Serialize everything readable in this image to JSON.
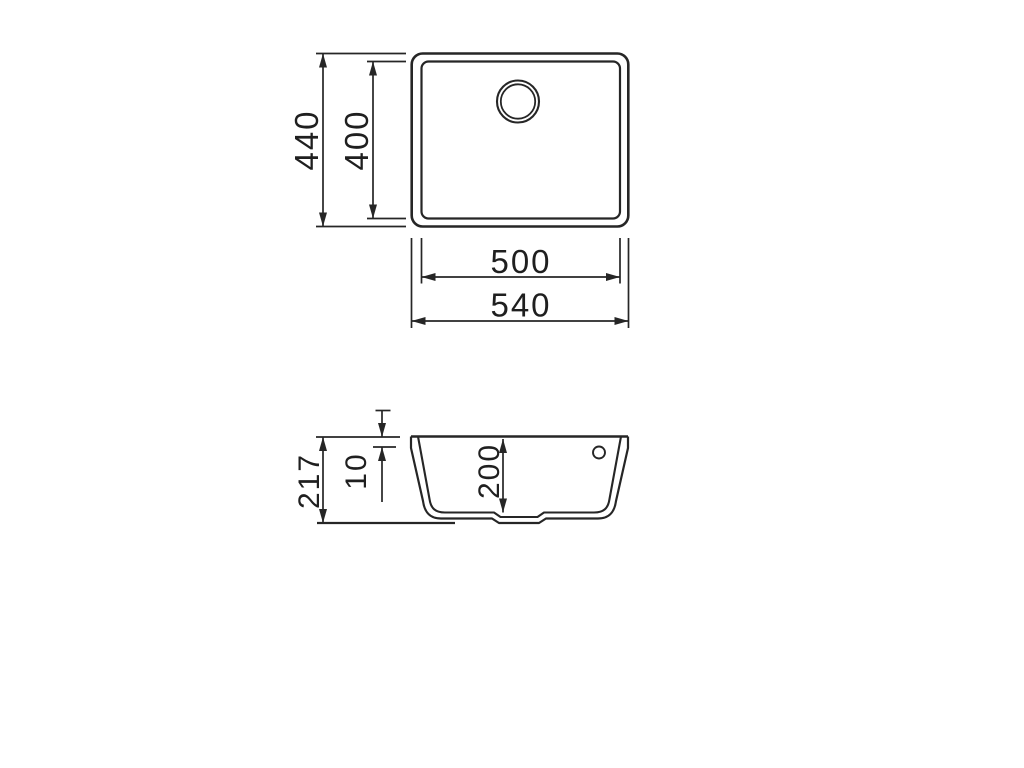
{
  "colors": {
    "line": "#262626",
    "text": "#1f1f1f",
    "background": "#ffffff"
  },
  "top_view": {
    "outer_height": "440",
    "inner_height": "400",
    "inner_width": "500",
    "outer_width": "540"
  },
  "section_view": {
    "total_height": "217",
    "rim_height": "10",
    "bowl_depth": "200"
  }
}
